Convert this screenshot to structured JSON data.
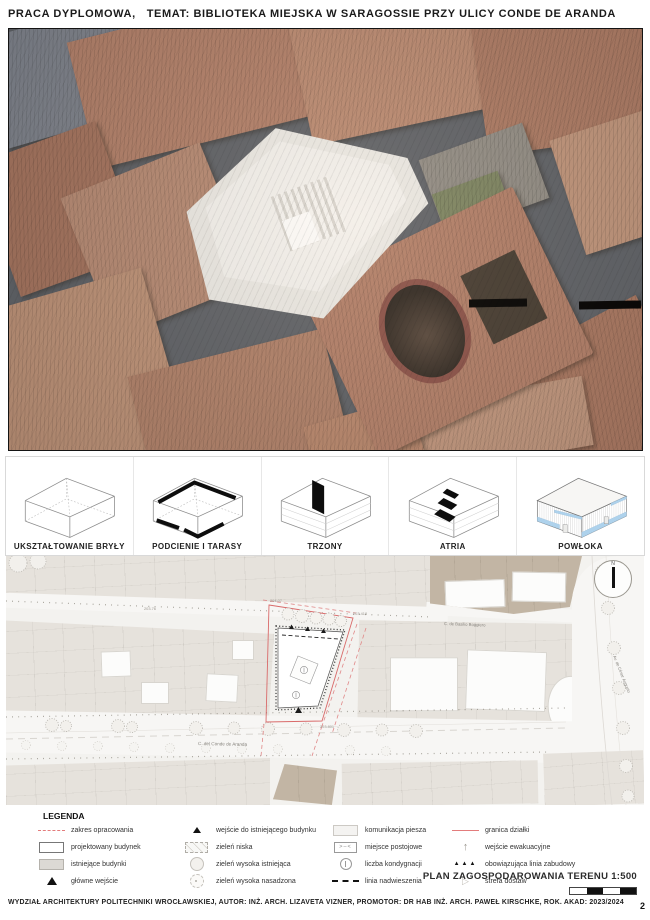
{
  "header": {
    "title": "PRACA DYPLOMOWA,   TEMAT: BIBLIOTEKA MIEJSKA W SARAGOSSIE PRZY ULICY CONDE DE ARANDA"
  },
  "diagrams": [
    {
      "label": "UKSZTAŁTOWANIE BRYŁY"
    },
    {
      "label": "PODCIENIE I TARASY"
    },
    {
      "label": "TRZONY"
    },
    {
      "label": "ATRIA"
    },
    {
      "label": "POWŁOKA"
    }
  ],
  "plan": {
    "title": "PLAN ZAGOSPODAROWANIA TERENU 1:500",
    "north": "N",
    "streets": {
      "conde": "C. del Conde de Aranda",
      "boggiero": "C. de Basilio Boggiero",
      "cesar": "Av. de César Augusto"
    },
    "elevations": {
      "a": "203.76",
      "b": "204.07",
      "c": "203.418",
      "d": "203.801"
    }
  },
  "legend": {
    "title": "LEGENDA",
    "col1": [
      {
        "symbol": "red-dashed-line",
        "label": "zakres opracowania"
      },
      {
        "symbol": "proposed-building-swatch",
        "label": "projektowany budynek"
      },
      {
        "symbol": "existing-buildings-swatch",
        "label": "istniejące budynki"
      },
      {
        "symbol": "main-entrance-triangle",
        "label": "główne wejście"
      }
    ],
    "col2": [
      {
        "symbol": "existing-entrance-triangle",
        "label": "wejście do istniejącego budynku"
      },
      {
        "symbol": "low-greenery-swatch",
        "label": "zieleń niska"
      },
      {
        "symbol": "existing-tree",
        "label": "zieleń wysoka istniejąca"
      },
      {
        "symbol": "planted-tree",
        "label": "zieleń wysoka nasadzona"
      }
    ],
    "col3": [
      {
        "symbol": "pedestrian-route-swatch",
        "label": "komunikacja piesza"
      },
      {
        "symbol": "parking-space",
        "label": "miejsce postojowe"
      },
      {
        "symbol": "storey-count-circle",
        "label": "liczba kondygnacji"
      },
      {
        "symbol": "overhang-line",
        "label": "linia nadwieszenia"
      }
    ],
    "col4": [
      {
        "symbol": "red-solid-line",
        "label": "granica działki"
      },
      {
        "symbol": "evacuation-arrow",
        "label": "wejście ewakuacyjne"
      },
      {
        "symbol": "building-line-triangles",
        "label": "obowiązująca linia zabudowy"
      },
      {
        "symbol": "delivery-zone-triangle",
        "label": "strefa dostaw"
      }
    ]
  },
  "footer": {
    "credits": "WYDZIAŁ ARCHITEKTURY POLITECHNIKI WROCŁAWSKIEJ, AUTOR: INŻ. ARCH. LIZAVETA VIZNER, PROMOTOR: DR HAB INŻ. ARCH. PAWEŁ KIRSCHKE, ROK. AKAD: 2023/2024",
    "page": "2"
  },
  "colors": {
    "accent_red": "#e37c7c",
    "powloka_blue": "#aed2ec",
    "existing_gray": "#dcd9d4",
    "roof_tone": "#b5836c"
  }
}
